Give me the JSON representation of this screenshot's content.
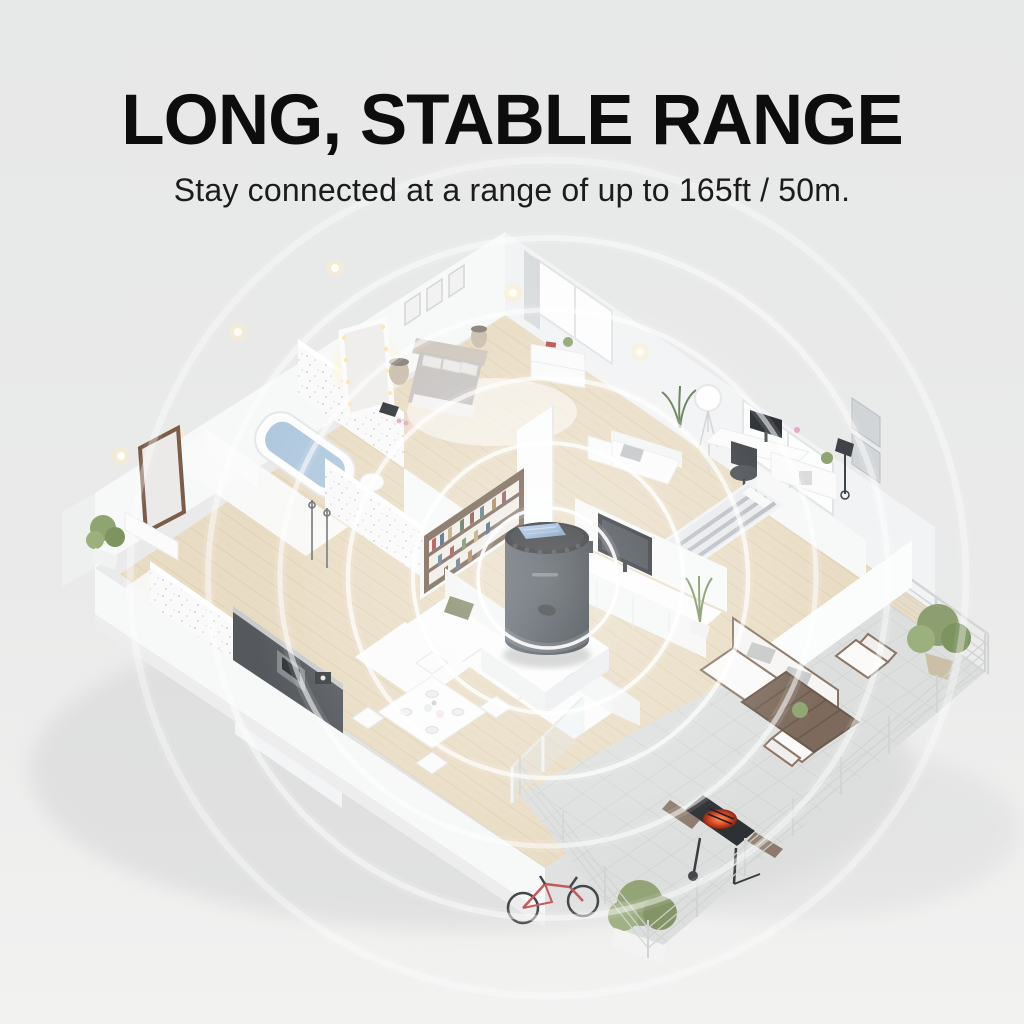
{
  "header": {
    "title": "LONG, STABLE RANGE",
    "subtitle": "Stay connected at a range of up to 165ft / 50m."
  },
  "device": {
    "type": "smart-hub-with-top-display",
    "body_color": "#3e464e",
    "top_color": "#17191c",
    "screen_color": "#8fb0d6",
    "location": "living-room-pedestal"
  },
  "signal": {
    "ring_count": 6,
    "ring_color": "#ffffff",
    "center": "device"
  },
  "colors": {
    "background_top": "#e7e8e8",
    "background_bottom": "#f2f2f1",
    "title_text": "#0d0d0d",
    "subtitle_text": "#1c1c1c",
    "walls": "#f6f7f7",
    "wood_floor": "#e9dcc4",
    "tile_floor": "#dcdfde",
    "plant_green": "#8fa571",
    "grill_glow": "#e4532c",
    "bicycle_red": "#c25b5b",
    "outdoor_wood": "#8a7464",
    "bookshelf_wood": "#715c4b",
    "kitchen_dark": "#55595d",
    "bath_water": "#a9c3dc"
  },
  "scene": {
    "style": "isometric-cutaway-apartment",
    "rooms": [
      "master-bedroom",
      "master-bathroom",
      "entry-hall",
      "office",
      "reading-nook",
      "second-bedroom",
      "living-room",
      "kitchen",
      "dining-area",
      "guest-bathroom",
      "terrace"
    ],
    "objects": [
      "double-bed",
      "lighted-vanity-mirror",
      "wall-frames",
      "bedside-lamps",
      "dresser",
      "bathtub",
      "toilet",
      "standing-mirror",
      "console-table",
      "desk",
      "monitor",
      "office-chair",
      "tripod-ball-lamp",
      "loveseat",
      "wall-art",
      "floor-lamp",
      "striped-bed",
      "tv",
      "tv-cabinet",
      "bookshelf",
      "sectional-sofa",
      "kitchen-cabinets",
      "cooktop-counter",
      "dining-table",
      "outdoor-sofa",
      "outdoor-armchairs",
      "outdoor-coffee-table",
      "charcoal-grill",
      "potted-plants",
      "bicycle",
      "terrace-railing"
    ]
  }
}
